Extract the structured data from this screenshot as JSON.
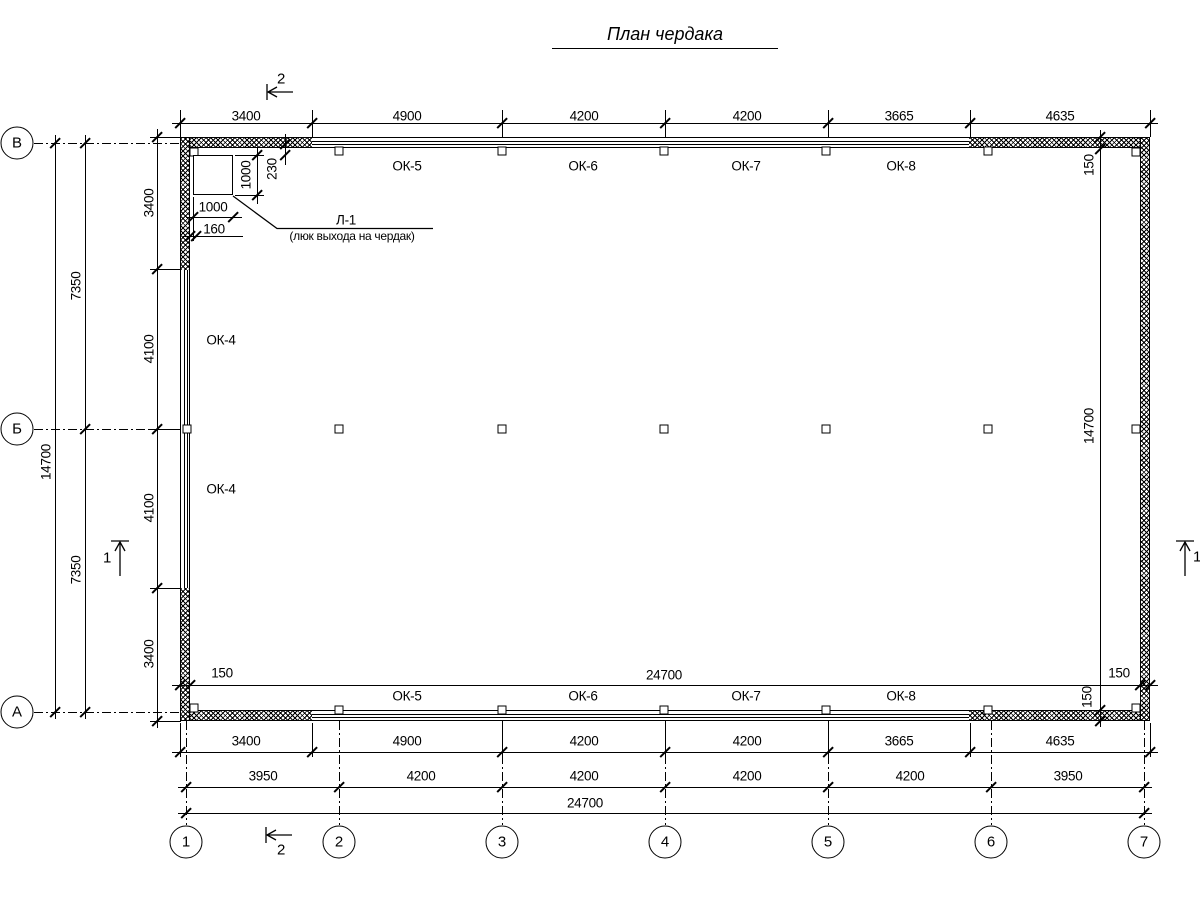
{
  "title": "План чердака",
  "axes": {
    "left": [
      "В",
      "Б",
      "А"
    ],
    "bottom": [
      "1",
      "2",
      "3",
      "4",
      "5",
      "6",
      "7"
    ]
  },
  "sections": {
    "one": "1",
    "two": "2"
  },
  "windows": {
    "left": [
      "ОК-4",
      "ОК-4"
    ],
    "top": [
      "ОК-5",
      "ОК-6",
      "ОК-7",
      "ОК-8"
    ],
    "bottom": [
      "ОК-5",
      "ОК-6",
      "ОК-7",
      "ОК-8"
    ]
  },
  "hatch_callout": {
    "label": "Л-1",
    "description": "(люк выхода на чердак)",
    "width": "1000",
    "height": "1000",
    "offset_top": "230",
    "offset_left": "160"
  },
  "dims": {
    "top": [
      "3400",
      "4900",
      "4200",
      "4200",
      "3665",
      "4635"
    ],
    "bottom_row1": [
      "3400",
      "4900",
      "4200",
      "4200",
      "3665",
      "4635"
    ],
    "bottom_row2": [
      "3950",
      "4200",
      "4200",
      "4200",
      "4200",
      "3950"
    ],
    "bottom_total": "24700",
    "left_inner": [
      "3400",
      "4100",
      "4100",
      "3400"
    ],
    "left_mid": [
      "7350",
      "7350"
    ],
    "left_total": "14700",
    "interior_width": "24700",
    "interior_height": "14700",
    "wall_thickness": {
      "top_wall": "150",
      "left_wall": "150",
      "right_wall": "150",
      "bottom_wall": "150"
    }
  }
}
